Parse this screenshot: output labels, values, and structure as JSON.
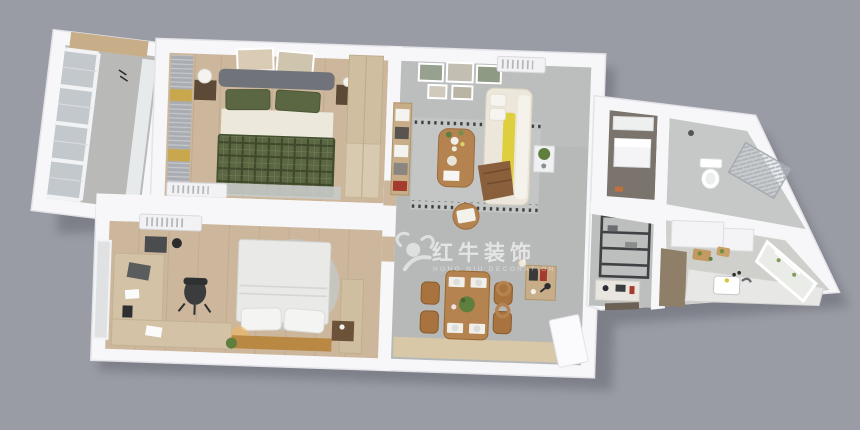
{
  "background_color": "#9a9ca5",
  "watermark": {
    "logo_icon": "bull-icon",
    "brand_zh": "红牛装饰",
    "brand_en": "HONG NIU DECORATION"
  },
  "palette": {
    "wall": "#f7f7f9",
    "wall_edge": "#e3e3e8",
    "wood_floor": "#cdb79c",
    "tile_floor": "#b7b9b8",
    "entry_wood": "#d8c8a8",
    "balcony_floor": "#b9bab8",
    "glass": "#c3c8cd",
    "curtain_gray": "#a9adb2",
    "curtain_gold": "#c9a74f",
    "bed_green": "#5a6742",
    "bed_green_dark": "#43502f",
    "headboard_gray": "#70747a",
    "bed_white": "#e9e9e7",
    "bed_base_wood": "#b98843",
    "sofa_cream": "#ece7da",
    "sofa_yellow": "#ddcf3d",
    "throw_brown": "#8a5f3c",
    "table_wood": "#b5834f",
    "chair_wood": "#a8733f",
    "rug_gray": "#c3c6c4",
    "shelf_dark": "#3f4144",
    "cabinet_wood": "#c8ae88",
    "wardrobe_wood": "#cfbfa0",
    "kitchen_wood": "#8f7f68",
    "appliance_white": "#f4f4f6",
    "plant_green": "#5f7f3f",
    "utility_floor": "#7a746d",
    "lamp_black": "#2e2e30"
  },
  "rooms": [
    {
      "name": "balcony",
      "features": [
        "floor-to-ceiling-windows",
        "sheer-curtain",
        "storage-cabinet"
      ]
    },
    {
      "name": "master-bedroom",
      "features": [
        "double-bed-green-plaid",
        "gray-headboard",
        "two-wall-frames",
        "nightstands-with-lamps",
        "striped-curtains",
        "wardrobe",
        "air-conditioner",
        "rug"
      ]
    },
    {
      "name": "second-bedroom",
      "features": [
        "double-bed-white",
        "wood-bed-bench",
        "round-rug",
        "l-shaped-desk",
        "desk-chair",
        "laptop",
        "air-conditioner",
        "window-blind",
        "wardrobe",
        "plant"
      ]
    },
    {
      "name": "living-room",
      "features": [
        "cream-sofa-yellow-cushions",
        "brown-throw",
        "coffee-table-with-flowers",
        "patterned-rug",
        "gallery-wall-five-frames",
        "shelf-unit",
        "air-conditioner",
        "side-table-plant",
        "round-stool"
      ]
    },
    {
      "name": "dining-room",
      "features": [
        "wood-dining-table",
        "four-chairs",
        "four-place-settings",
        "centerpiece-plant",
        "study-desk",
        "desk-lamp",
        "wall-lamp",
        "wood-wall-hooks",
        "entry-wood-floor",
        "white-door"
      ]
    },
    {
      "name": "hallway",
      "features": [
        "metal-shelving-rack",
        "console-table"
      ]
    },
    {
      "name": "utility-room",
      "features": [
        "white-vanity-unit",
        "wall-cabinet"
      ]
    },
    {
      "name": "bathroom",
      "features": [
        "toilet",
        "glass-shower-screen",
        "shower-head"
      ]
    },
    {
      "name": "kitchen",
      "features": [
        "white-cabinets",
        "counter-with-sink",
        "faucet",
        "cutting-boards",
        "vegetables",
        "wood-pantry",
        "window"
      ]
    }
  ]
}
